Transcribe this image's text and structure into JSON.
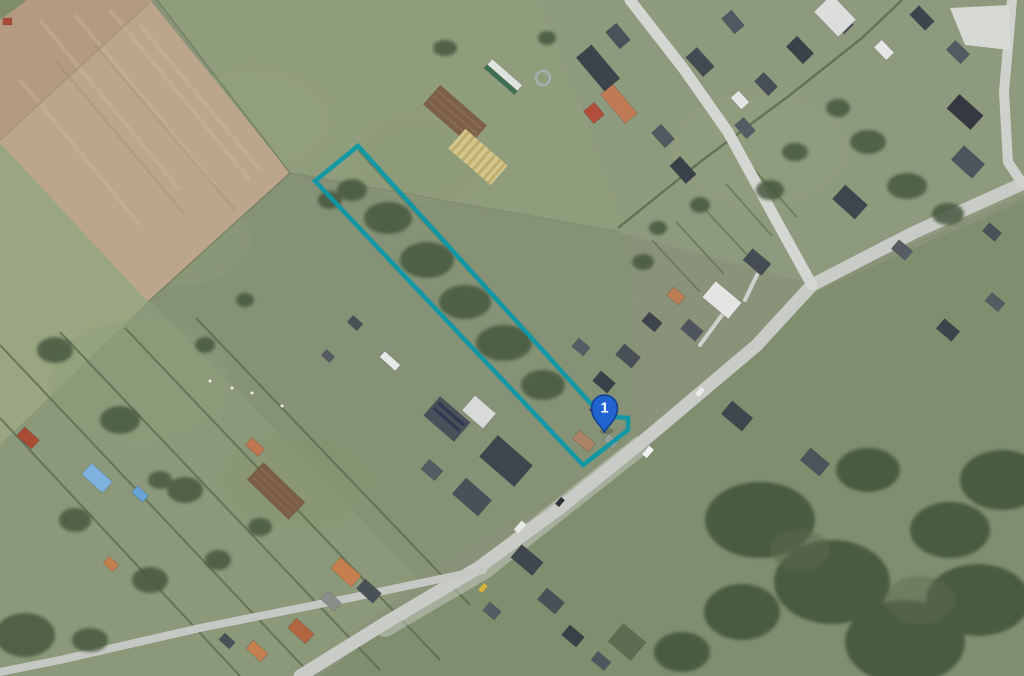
{
  "map": {
    "view": "aerial-satellite",
    "marker": {
      "label": "1",
      "fill": "#2163cf",
      "stroke": "#16418e",
      "label_color": "#ffffff"
    },
    "parcel": {
      "outline_color": "#0d98a6",
      "outline_width": "4.5"
    }
  }
}
